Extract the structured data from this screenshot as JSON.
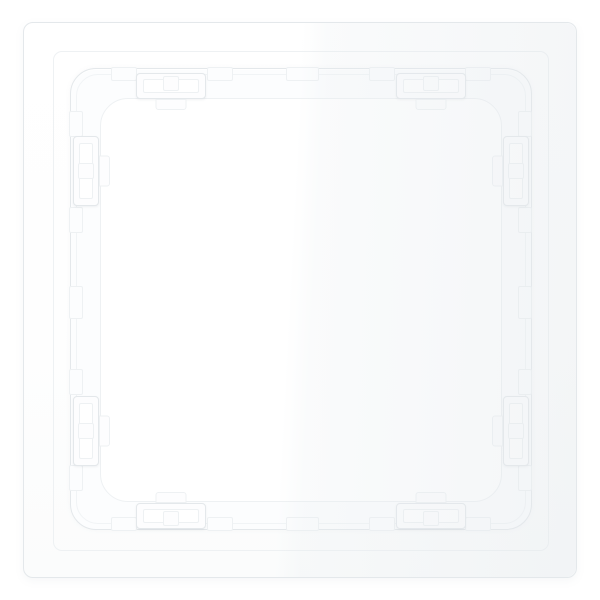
{
  "scene": {
    "description": "Rear view of a glossy white square wall-switch mounting frame with eight snap-fit clips and a castellated inner ridge, photographed on a plain white background",
    "object": "wall-switch-frame",
    "view": "rear",
    "clip_count": 8,
    "notch_count": 20
  },
  "colors": {
    "background": "#ffffff",
    "plate": "#ffffff",
    "line": "#e4e8eb",
    "line_soft": "#eef1f3",
    "ridge_fill": "#fcfdfe",
    "clip_fill": "#fdfdfe",
    "aperture": "#ffffff"
  }
}
